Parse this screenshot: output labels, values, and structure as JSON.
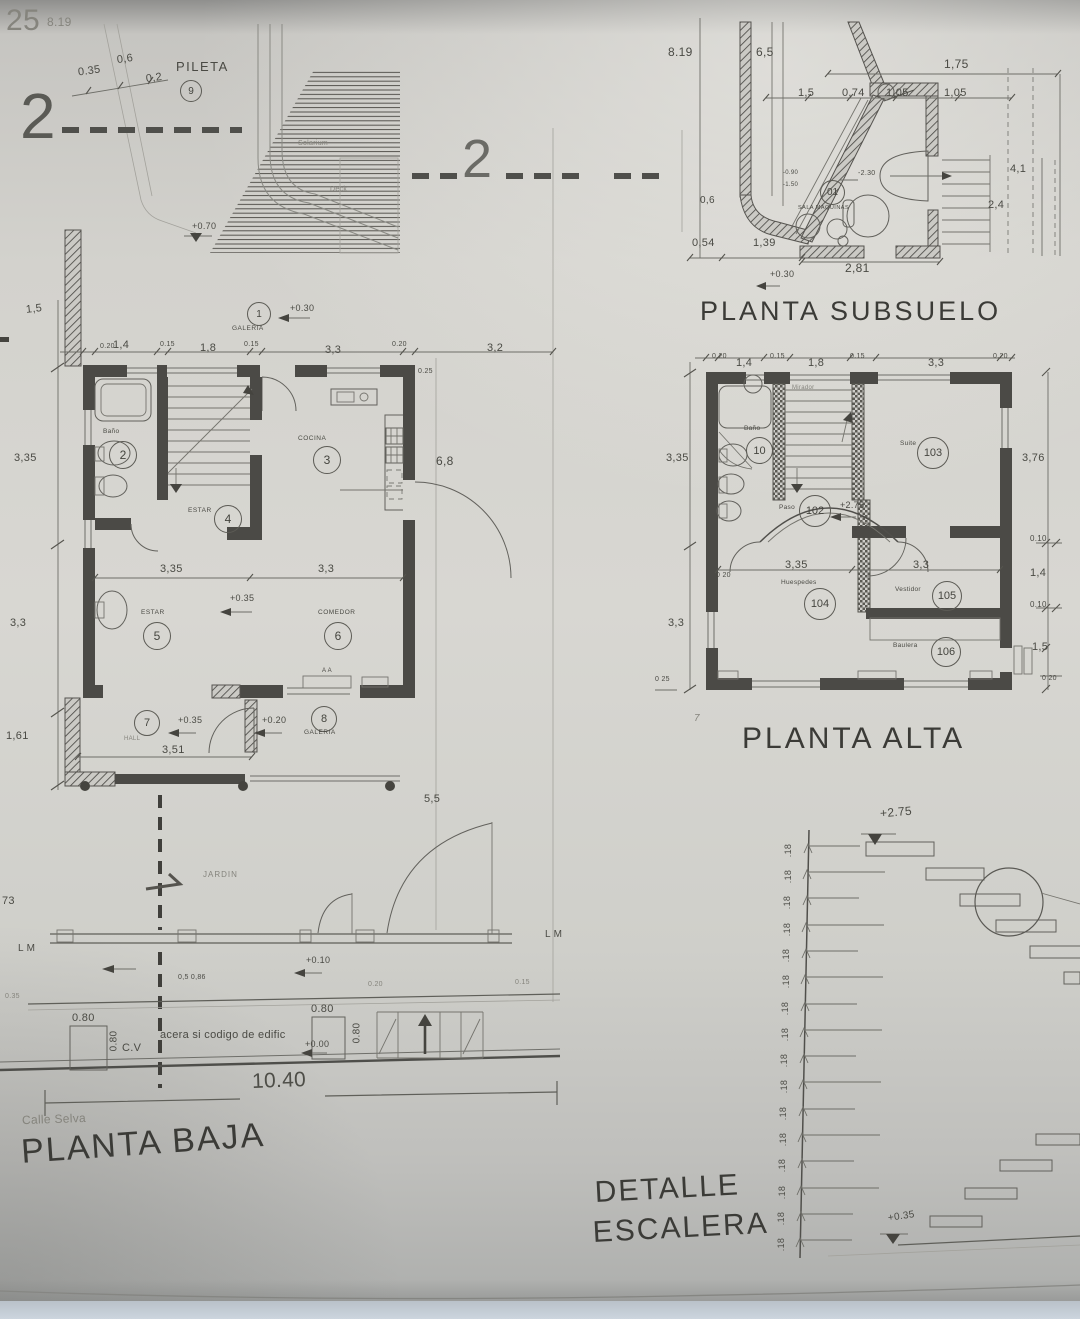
{
  "colors": {
    "paper": "#d6d5d0",
    "ink": "#4a4a45",
    "wall": "#4b4a46",
    "blue_strip": "#ccd5de"
  },
  "sheet": {
    "corner_num": "25",
    "corner_dim": "8.19",
    "section_left": "2",
    "section_mid": "2"
  },
  "pool": {
    "d035": "0.35",
    "d06": "0,6",
    "d02": "0,2",
    "name": "PILETA",
    "num": "9",
    "solarium": "Solarium",
    "deck": "Deck",
    "lvl": "+0.70"
  },
  "sub": {
    "title": "PLANTA SUBSUELO",
    "d819": "8.19",
    "d65": "6,5",
    "d175": "1,75",
    "d15": "1,5",
    "d074": "0,74",
    "d105a": "1,05",
    "d105b": "1,05",
    "d41": "4,1",
    "d24": "2,4",
    "d054": "0,54",
    "d139": "1,39",
    "d281": "2,81",
    "lvl030": "+0.30",
    "lvl230": "-2.30",
    "lvl090": "-0.90",
    "lvl150": "-1.50",
    "d06": "0,6",
    "num": "01",
    "room": "SALA MAQUINAS"
  },
  "baja": {
    "title": "PLANTA BAJA",
    "street": "Calle Selva",
    "sidewalk": "acera si codigo de edific",
    "width": "10.40",
    "lm": "L M",
    "lm2": "L M",
    "jardin": "JARDIN",
    "cv": "C.V",
    "t020a": "0.20",
    "t14": "1,4",
    "t015a": "0.15",
    "t18": "1,8",
    "t015b": "0.15",
    "t33": "3,3",
    "t020b": "0.20",
    "l15": "1,5",
    "l335": "3,35",
    "l33": "3,3",
    "l161": "1,61",
    "r32": "3,2",
    "r025": "0.25",
    "r68": "6,8",
    "r55": "5,5",
    "m335": "3,35",
    "m33": "3,3",
    "m351": "3,51",
    "b0586": "0,5 0,86",
    "b020": "0.20",
    "b015": "0.15",
    "b035": "0.35",
    "b173": "73",
    "lvl010": "+0.10",
    "lvl000": "+0.00",
    "lvl030": "+0.30",
    "lvl035a": "+0.35",
    "lvl035b": "+0.35",
    "lvl020": "+0.20",
    "g1": "1",
    "g1name": "GALERIA",
    "r2": "2",
    "r2name": "Baño",
    "r3": "3",
    "r3name": "COCINA",
    "r4": "4",
    "r4name": "ESTAR",
    "r5": "5",
    "r5name": "ESTAR",
    "r6": "6",
    "r6name": "COMEDOR",
    "r7": "7",
    "r7name": "HALL",
    "r8": "8",
    "r8name": "GALERIA",
    "box080a": "0.80",
    "box080as": "0.80",
    "box080b": "0.80",
    "box080bs": "0.80",
    "aa": "A A"
  },
  "alta": {
    "title": "PLANTA ALTA",
    "t020a": "0.20",
    "t14": "1,4",
    "t015a": "0.15",
    "t18": "1,8",
    "t015b": "0.15",
    "t33": "3,3",
    "t020b": "0.20",
    "l335": "3,35",
    "l33": "3,3",
    "l025": "0 25",
    "r376": "3,76",
    "r010a": "0.10",
    "r14": "1,4",
    "r010b": "0.10",
    "r15": "1,5",
    "r020": "0 20",
    "m335": "3,35",
    "m33": "3,3",
    "m020": "0 20",
    "mirador": "Mirador",
    "r10": "10",
    "r10name": "Baño",
    "r103": "103",
    "r103name": "Suite",
    "r102": "102",
    "r102name": "Paso",
    "lvl275": "+2.75",
    "r104": "104",
    "r104name": "Huespedes",
    "r105": "105",
    "r105name": "Vestidor",
    "r106": "106",
    "r106name": "Baulera",
    "mark7": "7"
  },
  "esc": {
    "t1": "DETALLE",
    "t2": "ESCALERA",
    "top": "+2.75",
    "bot": "+0.35",
    "riser": ".18"
  }
}
